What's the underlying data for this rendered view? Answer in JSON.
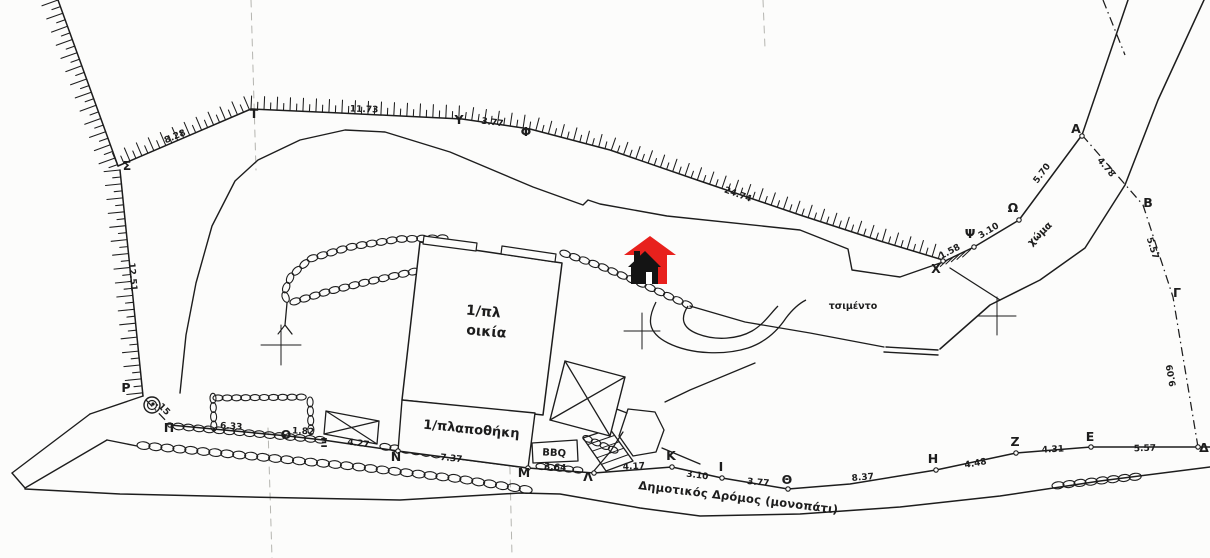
{
  "plan": {
    "colors": {
      "ink": "#1d1d1d",
      "paper": "#fcfcfb",
      "marker_red": "#e8211d",
      "marker_black": "#141414",
      "crease": "#b5b5b0"
    },
    "road": {
      "label": "Δημοτικός Δρόμος (μονοπάτι)",
      "x": 638,
      "y": 489,
      "rot": 7,
      "size": 11.5
    },
    "area_labels": [
      {
        "id": "cement",
        "text": "τσιμέντο",
        "x": 853,
        "y": 309,
        "rot": 0,
        "size": 9.5
      },
      {
        "id": "soil",
        "text": "χώμα",
        "x": 1042,
        "y": 236,
        "rot": -44,
        "size": 10
      }
    ],
    "building_labels": [
      {
        "id": "house-storeys",
        "text": "1/πλ",
        "x": 483,
        "y": 316,
        "rot": 5,
        "size": 14
      },
      {
        "id": "house-name",
        "text": "οικία",
        "x": 486,
        "y": 336,
        "rot": 5,
        "size": 14
      },
      {
        "id": "storage-storeys",
        "text": "1/πλ",
        "x": 439,
        "y": 430,
        "rot": 5,
        "size": 13
      },
      {
        "id": "storage-name",
        "text": "αποθήκη",
        "x": 487,
        "y": 435,
        "rot": 5,
        "size": 13
      },
      {
        "id": "bbq",
        "text": "BBQ",
        "x": 554,
        "y": 456,
        "rot": 3,
        "size": 10
      }
    ],
    "boundary_points": [
      {
        "name": "Α",
        "x": 1076,
        "y": 133
      },
      {
        "name": "Β",
        "x": 1148,
        "y": 207
      },
      {
        "name": "Γ",
        "x": 1177,
        "y": 297
      },
      {
        "name": "Δ",
        "x": 1204,
        "y": 452
      },
      {
        "name": "Ε",
        "x": 1090,
        "y": 441
      },
      {
        "name": "Ζ",
        "x": 1015,
        "y": 446
      },
      {
        "name": "Η",
        "x": 933,
        "y": 463
      },
      {
        "name": "Θ",
        "x": 787,
        "y": 484
      },
      {
        "name": "Ι",
        "x": 721,
        "y": 471
      },
      {
        "name": "Κ",
        "x": 671,
        "y": 460
      },
      {
        "name": "Λ",
        "x": 588,
        "y": 481
      },
      {
        "name": "Μ",
        "x": 524,
        "y": 477
      },
      {
        "name": "Ν",
        "x": 396,
        "y": 461
      },
      {
        "name": "Ξ",
        "x": 324,
        "y": 447
      },
      {
        "name": "Ο",
        "x": 286,
        "y": 439
      },
      {
        "name": "Π",
        "x": 169,
        "y": 432
      },
      {
        "name": "Ρ",
        "x": 126,
        "y": 392
      },
      {
        "name": "Σ",
        "x": 127,
        "y": 170
      },
      {
        "name": "Τ",
        "x": 254,
        "y": 118
      },
      {
        "name": "Υ",
        "x": 459,
        "y": 124
      },
      {
        "name": "Φ",
        "x": 526,
        "y": 136
      },
      {
        "name": "Χ",
        "x": 936,
        "y": 273
      },
      {
        "name": "Ψ",
        "x": 970,
        "y": 238
      },
      {
        "name": "Ω",
        "x": 1013,
        "y": 212
      }
    ],
    "measurements": [
      {
        "value": "8.28",
        "x": 176,
        "y": 139,
        "rot": -23
      },
      {
        "value": "11.73",
        "x": 364,
        "y": 112,
        "rot": 2
      },
      {
        "value": "3.77",
        "x": 492,
        "y": 125,
        "rot": 8
      },
      {
        "value": "24.74",
        "x": 737,
        "y": 197,
        "rot": 20
      },
      {
        "value": "12.51",
        "x": 130,
        "y": 277,
        "rot": 85
      },
      {
        "value": "1.58",
        "x": 951,
        "y": 254,
        "rot": -28
      },
      {
        "value": "3.10",
        "x": 990,
        "y": 233,
        "rot": -31
      },
      {
        "value": "5.70",
        "x": 1044,
        "y": 175,
        "rot": -53
      },
      {
        "value": "4.78",
        "x": 1104,
        "y": 169,
        "rot": 50
      },
      {
        "value": "5.57",
        "x": 1150,
        "y": 249,
        "rot": 72
      },
      {
        "value": "9.09",
        "x": 1174,
        "y": 375,
        "rot": -100
      },
      {
        "value": ".15",
        "x": 161,
        "y": 410,
        "rot": 45
      },
      {
        "value": "6.33",
        "x": 231,
        "y": 429,
        "rot": 4
      },
      {
        "value": "1.82",
        "x": 303,
        "y": 434,
        "rot": 3
      },
      {
        "value": "4.27",
        "x": 358,
        "y": 446,
        "rot": 8
      },
      {
        "value": "7.37",
        "x": 451,
        "y": 461,
        "rot": 6
      },
      {
        "value": "3.64",
        "x": 555,
        "y": 470,
        "rot": 4
      },
      {
        "value": "4.17",
        "x": 634,
        "y": 469,
        "rot": -3
      },
      {
        "value": "3.10",
        "x": 697,
        "y": 478,
        "rot": 8
      },
      {
        "value": "3.77",
        "x": 758,
        "y": 485,
        "rot": 5
      },
      {
        "value": "8.37",
        "x": 863,
        "y": 480,
        "rot": -5
      },
      {
        "value": "4.48",
        "x": 976,
        "y": 466,
        "rot": -10
      },
      {
        "value": "4.31",
        "x": 1053,
        "y": 452,
        "rot": -3
      },
      {
        "value": "5.57",
        "x": 1145,
        "y": 451,
        "rot": -2
      }
    ],
    "marker_icon": {
      "name": "house-location-marker"
    }
  }
}
